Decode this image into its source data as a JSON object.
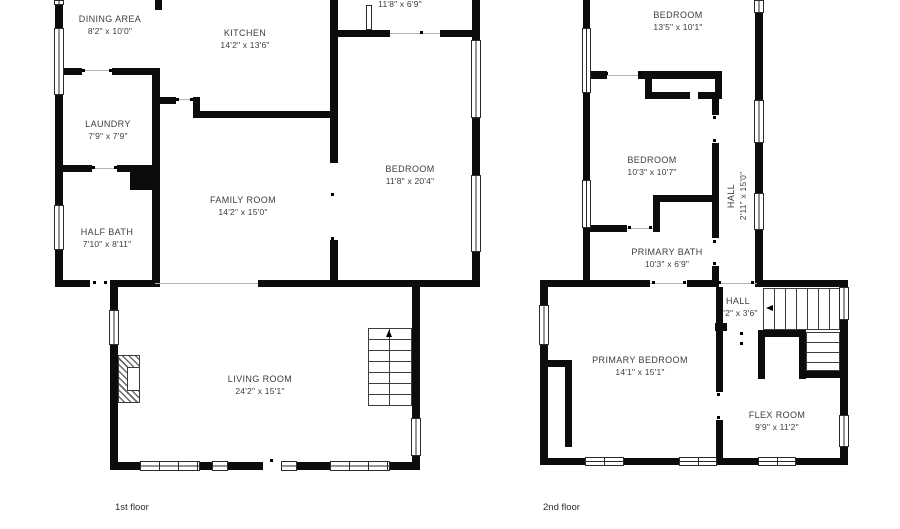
{
  "document": {
    "type": "floor-plan"
  },
  "colors": {
    "wall": "#0c0c0c",
    "text": "#3d3d3d",
    "background": "#ffffff"
  },
  "floors": [
    {
      "name": "1st floor",
      "rooms": [
        {
          "name": "",
          "dims": "11'8\" x 6'9\""
        },
        {
          "name": "DINING AREA",
          "dims": "8'2\" x 10'0\""
        },
        {
          "name": "KITCHEN",
          "dims": "14'2\" x 13'6\""
        },
        {
          "name": "LAUNDRY",
          "dims": "7'9\" x 7'9\""
        },
        {
          "name": "HALF BATH",
          "dims": "7'10\" x 8'11\""
        },
        {
          "name": "FAMILY ROOM",
          "dims": "14'2\" x 15'0\""
        },
        {
          "name": "BEDROOM",
          "dims": "11'8\" x 20'4\""
        },
        {
          "name": "LIVING ROOM",
          "dims": "24'2\" x 15'1\""
        }
      ]
    },
    {
      "name": "2nd floor",
      "rooms": [
        {
          "name": "BEDROOM",
          "dims": "13'5\" x 10'1\""
        },
        {
          "name": "BEDROOM",
          "dims": "10'3\" x 10'7\""
        },
        {
          "name": "HALL",
          "dims": "2'11\" x 15'0\""
        },
        {
          "name": "PRIMARY BATH",
          "dims": "10'3\" x 6'9\""
        },
        {
          "name": "HALL",
          "dims": "3'2\" x 3'6\""
        },
        {
          "name": "PRIMARY BEDROOM",
          "dims": "14'1\" x 15'1\""
        },
        {
          "name": "FLEX ROOM",
          "dims": "9'9\" x 11'2\""
        }
      ]
    }
  ]
}
